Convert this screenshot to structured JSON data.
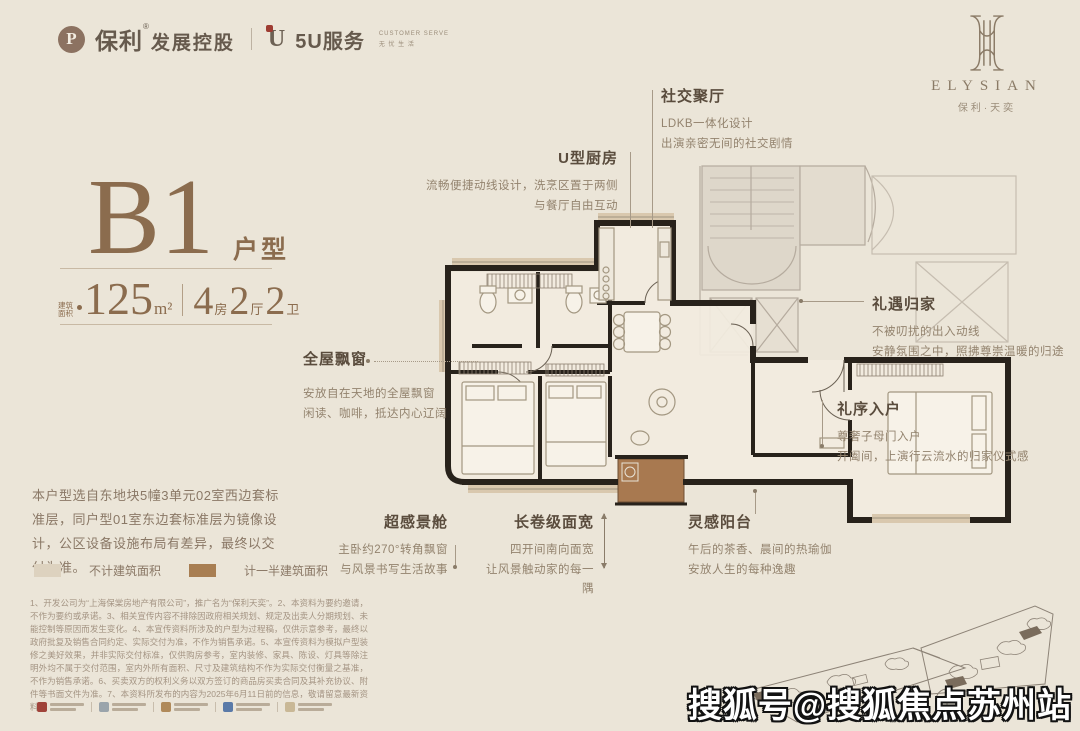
{
  "header": {
    "poly_logo": {
      "icon_glyph": "P",
      "brand": "保利",
      "reg": "®",
      "suffix": "发展控股"
    },
    "service_logo": {
      "icon_glyph": "U",
      "label": "5U服务",
      "tag_line1": "CUSTOMER SERVE",
      "tag_line2": "无 忧 生 活"
    },
    "project_logo": {
      "name": "ELYSIAN",
      "subtitle": "保利·天奕"
    }
  },
  "title_block": {
    "plan_code": "B1",
    "plan_suffix": "户型",
    "area_label_top": "建筑",
    "area_label_bottom": "面积",
    "area_value": "125",
    "area_unit": "m²",
    "spec": [
      {
        "num": "4",
        "unit": "房"
      },
      {
        "num": "2",
        "unit": "厅"
      },
      {
        "num": "2",
        "unit": "卫"
      }
    ]
  },
  "annotations": {
    "social": {
      "title": "社交聚厅",
      "line1": "LDKB一体化设计",
      "line2": "出演亲密无间的社交剧情"
    },
    "kitchen": {
      "title": "U型厨房",
      "line1": "流畅便捷动线设计，洗烹区置于两侧",
      "line2": "与餐厅自由互动"
    },
    "bay": {
      "title": "全屋飘窗",
      "line1": "安放自在天地的全屋飘窗",
      "line2": "闲读、咖啡，抵达内心辽阔"
    },
    "homecoming": {
      "title": "礼遇归家",
      "line1": "不被叨扰的出入动线",
      "line2": "安静氛围之中，照拂尊崇温暖的归途"
    },
    "entry": {
      "title": "礼序入户",
      "line1": "尊奢子母门入户",
      "line2": "开阖间，上演行云流水的归家仪式感"
    },
    "viewcabin": {
      "title": "超感景舱",
      "line1": "主卧约270°转角飘窗",
      "line2": "与风景书写生活故事"
    },
    "span": {
      "title": "长卷级面宽",
      "line1": "四开间南向面宽",
      "line2": "让风景触动家的每一隅"
    },
    "balcony": {
      "title": "灵感阳台",
      "line1": "午后的茶香、晨间的热瑜伽",
      "line2": "安放人生的每种逸趣"
    }
  },
  "description": "本户型选自东地块5幢3单元02室西边套标准层，同户型01室东边套标准层为镜像设计，公区设备设施布局有差异，最终以交付为准。",
  "legend": [
    {
      "label": "不计建筑面积",
      "color": "#ddd2bf"
    },
    {
      "label": "计一半建筑面积",
      "color": "#a87e52"
    }
  ],
  "disclaimer": "1、开发公司为“上海保棠房地产有限公司”，推广名为“保利天奕”。2、本资料为要约邀请，不作为要约或承诺。3、相关宣传内容不排除因政府相关规划、规定及出卖人分期规划、未能控制等原因而发生变化。4、本宣传资料所涉及的户型为过程稿，仅供示意参考，最终以政府批复及销售合同约定、实际交付为准，不作为销售承诺。5、本宣传资料为模拟户型装修之美好效果，并非实际交付标准，仅供购房参考，室内装修、家具、陈设、灯具等除注明外均不属于交付范围，室内外所有面积、尺寸及建筑结构不作为实际交付衡量之基准，不作为销售承诺。6、买卖双方的权利义务以双方签订的商品房买卖合同及其补充协议、附件等书面文件为准。7、本资料所发布的内容为2025年6月11日前的信息，敬请留意最新资料。",
  "partner_chips": [
    {
      "color": "#a0433a"
    },
    {
      "color": "#9aa4ab"
    },
    {
      "color": "#b08a5a"
    },
    {
      "color": "#5a7aa8"
    },
    {
      "color": "#c9b896"
    }
  ],
  "plan_colors": {
    "wall": "#28221b",
    "window_sill_tan": "#d9c8ae",
    "balcony_brown": "#a87950",
    "neighbor_gray": "#b5ab9e",
    "accent_brown": "#8b6c4e"
  },
  "watermark": "搜狐号@搜狐焦点苏州站"
}
